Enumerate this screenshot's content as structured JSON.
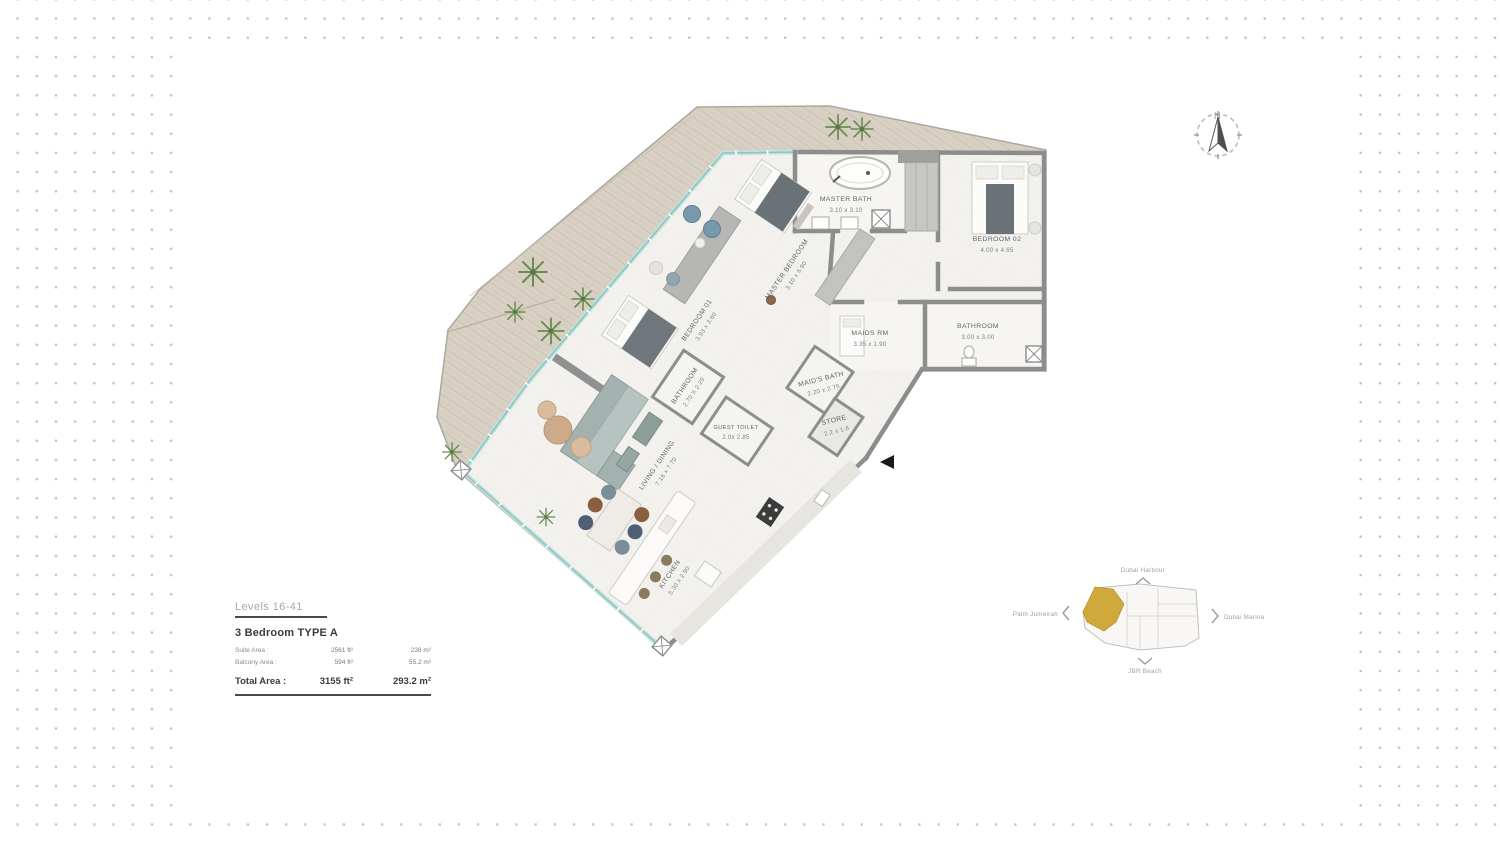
{
  "info_box": {
    "levels": "Levels 16-41",
    "unit_type": "3 Bedroom  TYPE A",
    "rows": [
      {
        "label": "Suite Area :",
        "ft": "2561 ft²",
        "m": "238 m²"
      },
      {
        "label": "Balcony Area :",
        "ft": "594 ft²",
        "m": "55.2 m²"
      }
    ],
    "total": {
      "label": "Total Area :",
      "ft": "3155 ft²",
      "m": "293.2 m²"
    }
  },
  "compass": {
    "north_label": "N"
  },
  "plan": {
    "rooms": [
      {
        "name": "MASTER BATH",
        "dims": "3.10 x 3.10"
      },
      {
        "name": "BEDROOM 02",
        "dims": "4.00 x 4.65"
      },
      {
        "name": "MASTER BEDROOM",
        "dims": "3.10 x 6.90"
      },
      {
        "name": "BEDROOM 01",
        "dims": "3.93 x 3.60"
      },
      {
        "name": "MAIDS RM",
        "dims": "3.35 x 1.90"
      },
      {
        "name": "BATHROOM",
        "dims": "3.00 x 3.00"
      },
      {
        "name": "MAID'S BATH",
        "dims": "2.20 x 2.75"
      },
      {
        "name": "STORE",
        "dims": "2.2 x 1.6"
      },
      {
        "name": "BATHROOM",
        "dims": "2.70 X 2.20"
      },
      {
        "name": "GUEST TOILET",
        "dims": "2.0x 2.85"
      },
      {
        "name": "LIVING / DINING",
        "dims": "7.16 x 7.70"
      },
      {
        "name": "KITCHEN",
        "dims": "5.30 x 2.90"
      }
    ]
  },
  "keyplan": {
    "labels": {
      "top": "Dubai Harbour",
      "left": "Palm Jumeirah",
      "right": "Dubai Marina",
      "bottom": "JBR Beach"
    },
    "unit_color": "#cfa93b"
  }
}
